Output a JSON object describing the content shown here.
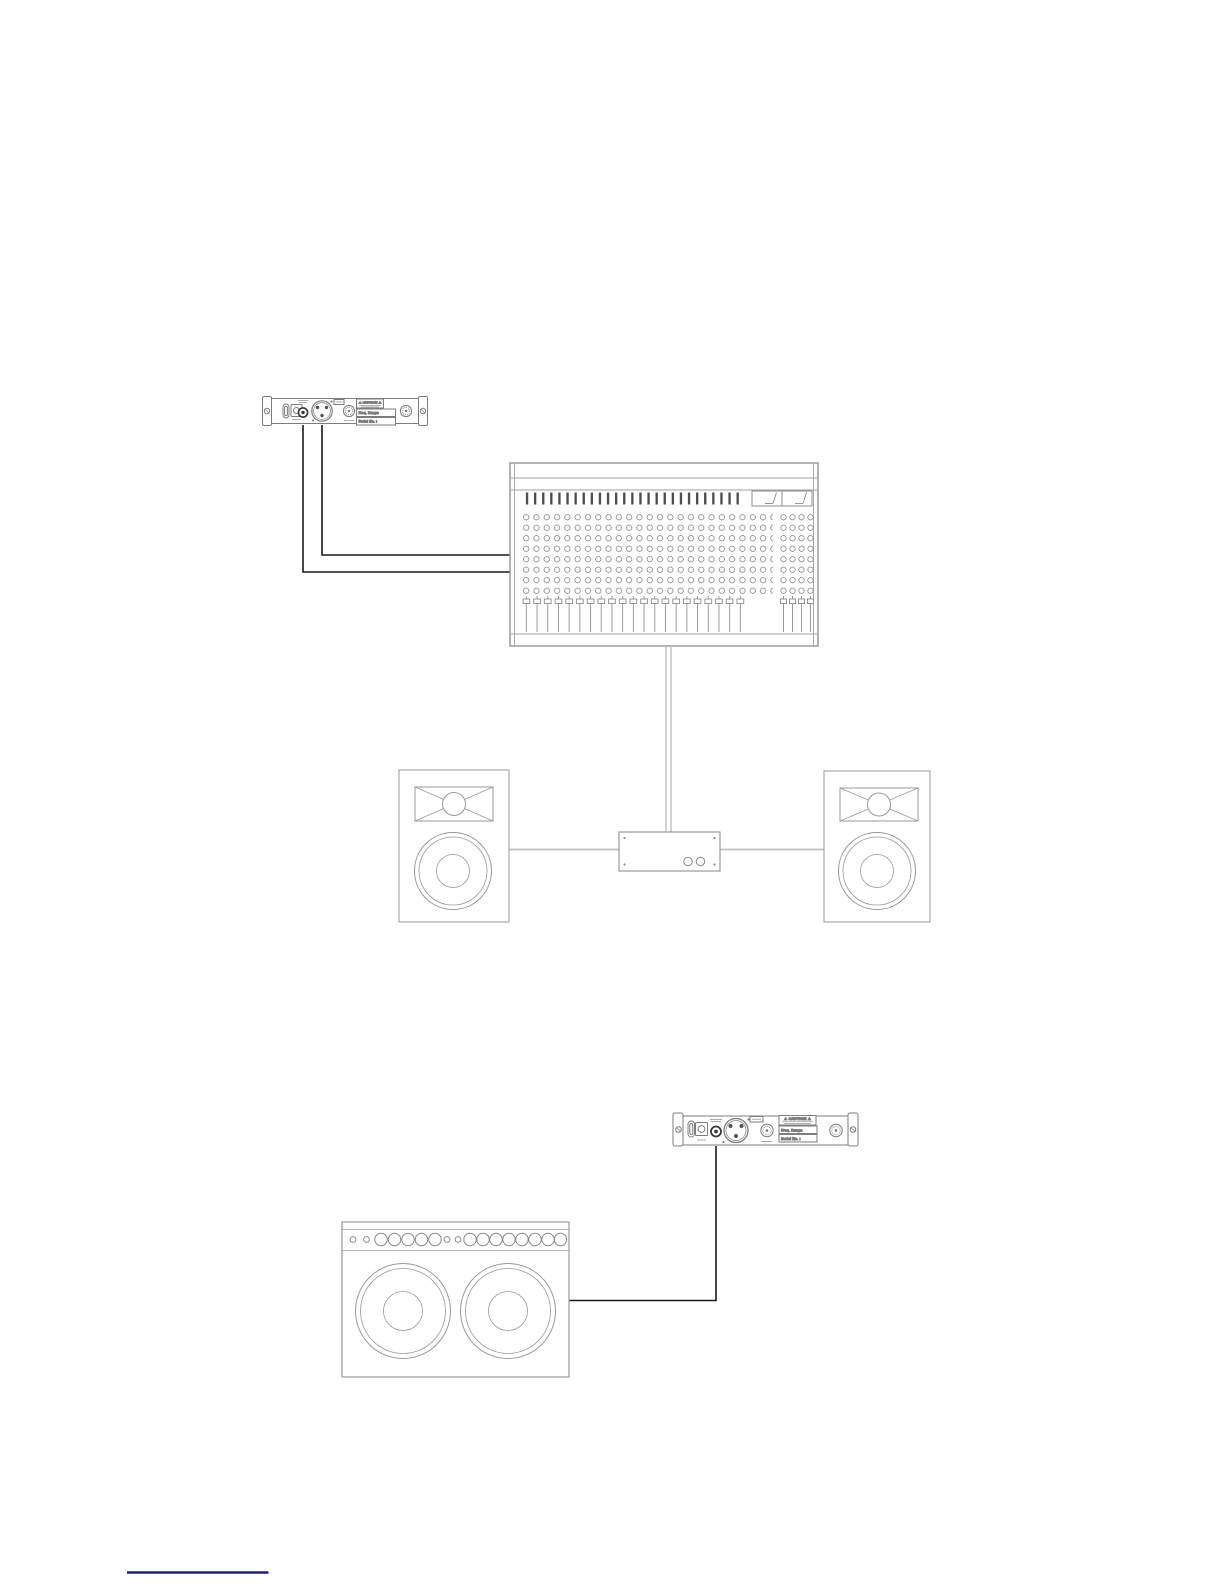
{
  "page": {
    "background_color": "#ffffff",
    "artwork_line_color": "#8c8c8c",
    "signal_cable_color": "#1a1a1a",
    "speaker_cable_color": "#c0c0c0",
    "footer_rule_color": "#1c1c8e"
  },
  "top_diagram": {
    "receiver_labels": {
      "caution": "⚠ CAUTION ⚠",
      "freq_range": "Freq. Range",
      "serial_no": "Serial No. :"
    }
  },
  "bottom_diagram": {
    "receiver_labels": {
      "caution": "⚠ CAUTION ⚠",
      "freq_range": "Freq. Range",
      "serial_no": "Serial No. :"
    }
  }
}
